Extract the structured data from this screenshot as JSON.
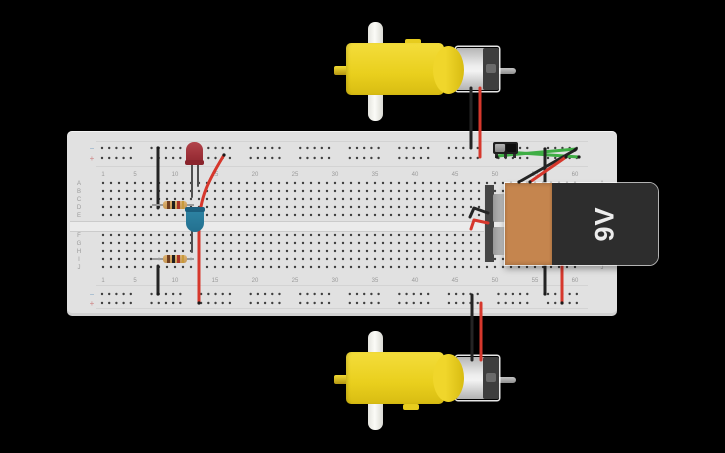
{
  "canvas": {
    "background": "#000000"
  },
  "battery": {
    "label": "9V",
    "body_color": "#2d2d2d",
    "wrap_color": "#c5854e",
    "terminal_color": "#b5b5b5"
  },
  "breadboard": {
    "body_color": "#e1e1e1",
    "hole_color": "#3e3e3e",
    "label_color": "#9a9a9a",
    "column_labels": [
      "1",
      "5",
      "10",
      "15",
      "20",
      "25",
      "30",
      "35",
      "40",
      "45",
      "50",
      "55",
      "60"
    ],
    "row_labels_upper": [
      "A",
      "B",
      "C",
      "D",
      "E"
    ],
    "row_labels_lower": [
      "F",
      "G",
      "H",
      "I",
      "J"
    ],
    "rail_negative_symbol": "−",
    "rail_positive_symbol": "+",
    "rail_negative_color": "#85a8c6",
    "rail_positive_color": "#cc8484"
  },
  "components": [
    {
      "name": "dc-motor-top",
      "color": "#efd526"
    },
    {
      "name": "dc-motor-bottom",
      "color": "#efd526"
    },
    {
      "name": "led-red",
      "color": "#9c3038"
    },
    {
      "name": "led-blue",
      "color": "#2f86a6"
    },
    {
      "name": "resistor-1",
      "band_colors": [
        "#6f3d20",
        "#1e1e1e",
        "#a93226",
        "#c79a3a"
      ]
    },
    {
      "name": "resistor-2",
      "band_colors": [
        "#6f3d20",
        "#1e1e1e",
        "#a93226",
        "#c79a3a"
      ]
    },
    {
      "name": "slide-switch",
      "color": "#1f1f1f"
    },
    {
      "name": "battery-9v",
      "label": "9V"
    }
  ],
  "wire_colors": {
    "black": "#242424",
    "red": "#d6372c",
    "green": "#3fae45",
    "lead_gray": "#4f4f4f"
  },
  "wires": [
    {
      "name": "led-red-lead-left",
      "color": "#4f4f4f",
      "width": 2,
      "layer": "under",
      "path": "M192,161 L192,197"
    },
    {
      "name": "led-red-lead-right",
      "color": "#4f4f4f",
      "width": 2,
      "layer": "under",
      "path": "M198,161 L198,186"
    },
    {
      "name": "led-blue-lead",
      "color": "#4f4f4f",
      "width": 2,
      "layer": "under",
      "path": "M192,229 L192,252"
    },
    {
      "name": "motor-top-black-lead",
      "color": "#242424",
      "width": 3,
      "layer": "under",
      "path": "M471,88 L471,148"
    },
    {
      "name": "motor-top-red-lead",
      "color": "#d6372c",
      "width": 3,
      "layer": "under",
      "path": "M480,88 L480,157"
    },
    {
      "name": "motor-bottom-black-lead",
      "color": "#242424",
      "width": 3,
      "layer": "under",
      "path": "M472,295 L472,360"
    },
    {
      "name": "motor-bottom-red-lead",
      "color": "#d6372c",
      "width": 3,
      "layer": "under",
      "path": "M481,303 L481,360"
    },
    {
      "name": "rail-to-rowD-black-wire",
      "color": "#242424",
      "width": 3,
      "layer": "under",
      "path": "M158,148 L158,208"
    },
    {
      "name": "rowJ-to-rail-black-wire",
      "color": "#242424",
      "width": 3,
      "layer": "under",
      "path": "M158,266 L158,294"
    },
    {
      "name": "long-red-wire",
      "color": "#d6372c",
      "width": 3,
      "layer": "under",
      "path": "M224,155 C212,175 199,195 199,228 L199,303"
    },
    {
      "name": "switch-green-wire-1",
      "color": "#3fae45",
      "width": 3,
      "layer": "under",
      "path": "M497,156 L576,149"
    },
    {
      "name": "switch-green-wire-2",
      "color": "#3fae45",
      "width": 3,
      "layer": "under",
      "path": "M506,152 L579,157"
    },
    {
      "name": "battery-black-vertical-upper",
      "color": "#242424",
      "width": 3,
      "layer": "under",
      "path": "M545,149 L545,184"
    },
    {
      "name": "battery-black-vertical-lower",
      "color": "#242424",
      "width": 3,
      "layer": "under",
      "path": "M545,261 L545,294"
    },
    {
      "name": "battery-red-vertical-lower",
      "color": "#d6372c",
      "width": 3,
      "layer": "under",
      "path": "M562,262 L562,303"
    },
    {
      "name": "battery-black-diagonal",
      "color": "#242424",
      "width": 3,
      "layer": "under",
      "path": "M519,182 L575,150"
    },
    {
      "name": "battery-red-diagonal",
      "color": "#d6372c",
      "width": 3,
      "layer": "under",
      "path": "M530,182 L566,157"
    },
    {
      "name": "battery-negative-hook",
      "color": "#242424",
      "width": 3,
      "layer": "over",
      "path": "M488,213 L474,208 L470,217"
    },
    {
      "name": "battery-positive-hook",
      "color": "#d6372c",
      "width": 3,
      "layer": "over",
      "path": "M488,223 L474,220 L471,229"
    }
  ],
  "wire_tips": [
    [
      497,
      157
    ],
    [
      506,
      152
    ],
    [
      576,
      149
    ],
    [
      579,
      157
    ],
    [
      519,
      182
    ],
    [
      575,
      150
    ],
    [
      530,
      182
    ],
    [
      566,
      157
    ],
    [
      224,
      155
    ],
    [
      545,
      149
    ],
    [
      158,
      148
    ],
    [
      158,
      294
    ],
    [
      545,
      294
    ],
    [
      562,
      303
    ],
    [
      199,
      303
    ]
  ]
}
